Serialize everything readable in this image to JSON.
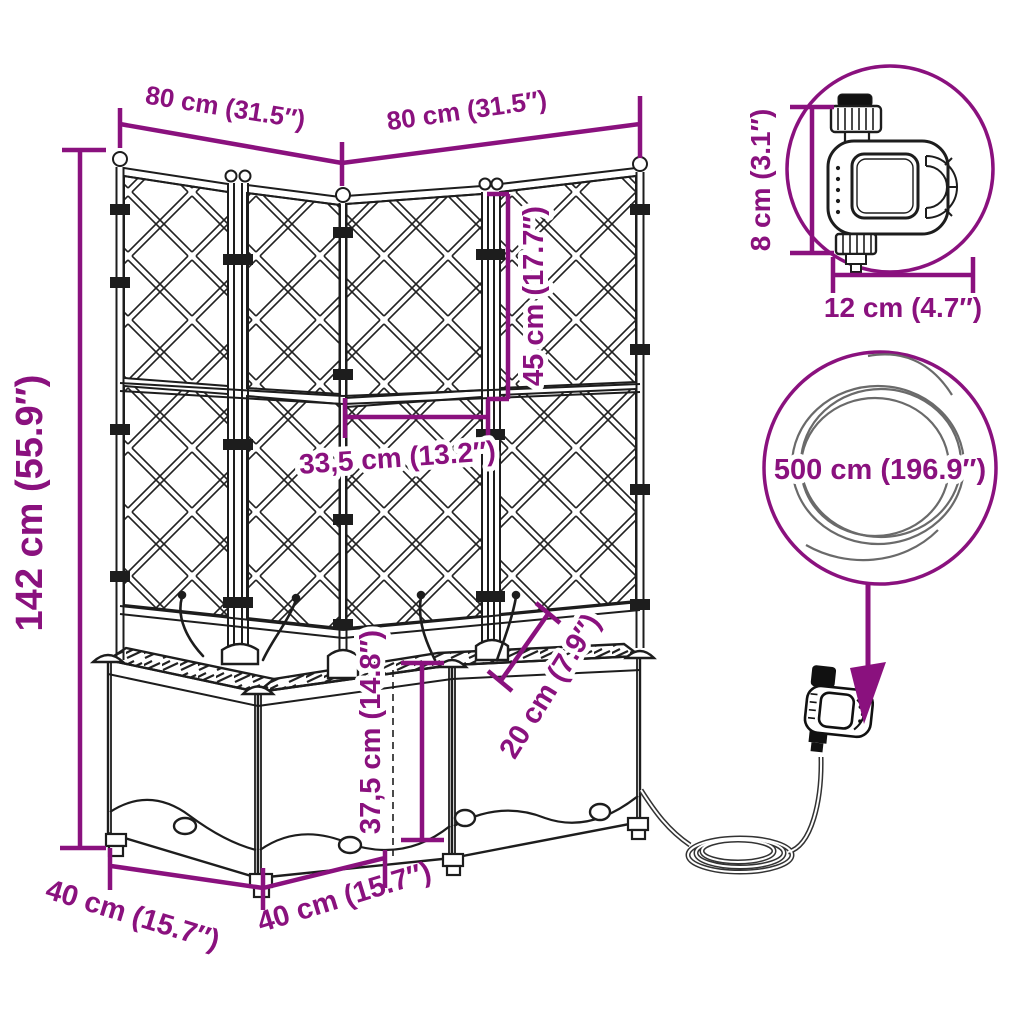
{
  "product": {
    "name": "corner-planter-with-trellis-and-automatic-watering-set"
  },
  "colors": {
    "dimension_accent": "#8A117E",
    "line_art": "#1d1d1d",
    "background": "#ffffff",
    "hose_gray": "#555555"
  },
  "dimensions": {
    "top_width_left": "80 cm (31.5″)",
    "top_width_right": "80 cm (31.5″)",
    "total_height": "142 cm (55.9″)",
    "trellis_section_height": "45 cm (17.7″)",
    "panel_width": "33,5 cm (13.2″)",
    "planter_height": "37,5 cm (14.8″)",
    "planter_inner_depth": "20 cm (7.9″)",
    "base_depth_left": "40 cm (15.7″)",
    "base_depth_right": "40 cm (15.7″)",
    "timer_height": "8 cm (3.1″)",
    "timer_width": "12 cm (4.7″)",
    "hose_length": "500 cm (196.9″)"
  }
}
